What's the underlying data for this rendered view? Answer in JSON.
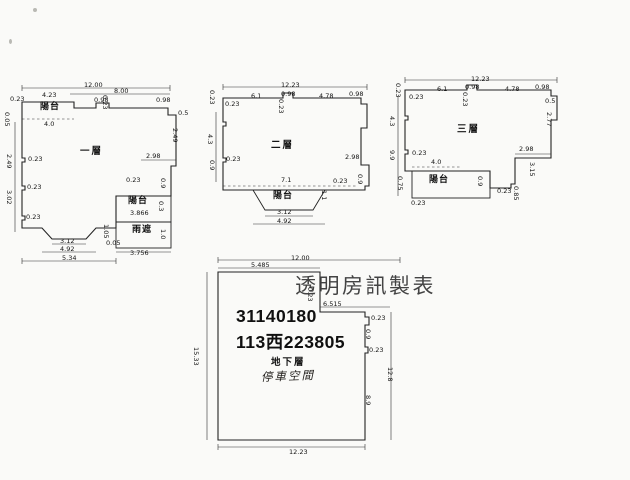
{
  "page": {
    "background": "#fafaf8",
    "line_color": "#232323"
  },
  "title_block": {
    "watermark": "透明房訊製表",
    "code_line1": "31140180",
    "code_line2": "113西223805"
  },
  "plans": [
    {
      "id": "floor1",
      "name": "一層",
      "labels": [
        {
          "t": "12.00",
          "x": 74,
          "y": 0
        },
        {
          "t": "4.23",
          "x": 32,
          "y": 10
        },
        {
          "t": "8.00",
          "x": 104,
          "y": 6
        },
        {
          "t": "0.98",
          "x": 84,
          "y": 15
        },
        {
          "t": "0.23",
          "x": 98,
          "y": 13,
          "r": 90
        },
        {
          "t": "0.98",
          "x": 146,
          "y": 15
        },
        {
          "t": "0.23",
          "x": 0,
          "y": 14
        },
        {
          "t": "陽台",
          "x": 30,
          "y": 22,
          "cls": "room"
        },
        {
          "t": "0.05",
          "x": 0,
          "y": 30,
          "r": 90
        },
        {
          "t": "4.0",
          "x": 34,
          "y": 39
        },
        {
          "t": "0.5",
          "x": 168,
          "y": 28
        },
        {
          "t": "2.49",
          "x": 168,
          "y": 46,
          "r": 90
        },
        {
          "t": "0.23",
          "x": 18,
          "y": 74
        },
        {
          "t": "2.49",
          "x": 2,
          "y": 72,
          "r": 90
        },
        {
          "t": "0.23",
          "x": 17,
          "y": 102
        },
        {
          "t": "3.02",
          "x": 2,
          "y": 108,
          "r": 90
        },
        {
          "t": "0.23",
          "x": 16,
          "y": 132
        },
        {
          "t": "2.98",
          "x": 136,
          "y": 71
        },
        {
          "t": "0.23",
          "x": 116,
          "y": 95
        },
        {
          "t": "0.9",
          "x": 156,
          "y": 96,
          "r": 90
        },
        {
          "t": "陽台",
          "x": 118,
          "y": 116,
          "cls": "room"
        },
        {
          "t": "3.866",
          "x": 120,
          "y": 128
        },
        {
          "t": "0.3",
          "x": 154,
          "y": 119,
          "r": 90
        },
        {
          "t": "雨遮",
          "x": 122,
          "y": 145,
          "cls": "room"
        },
        {
          "t": "1.05",
          "x": 99,
          "y": 142,
          "r": 90
        },
        {
          "t": "0.05",
          "x": 96,
          "y": 158
        },
        {
          "t": "1.0",
          "x": 156,
          "y": 147,
          "r": 90
        },
        {
          "t": "3.756",
          "x": 120,
          "y": 168
        },
        {
          "t": "3.12",
          "x": 50,
          "y": 156
        },
        {
          "t": "4.92",
          "x": 50,
          "y": 164
        },
        {
          "t": "5.34",
          "x": 52,
          "y": 173
        }
      ]
    },
    {
      "id": "floor2",
      "name": "二層",
      "labels": [
        {
          "t": "12.23",
          "x": 68,
          "y": 0
        },
        {
          "t": "0.23",
          "x": 2,
          "y": 8,
          "r": 90
        },
        {
          "t": "6.1",
          "x": 38,
          "y": 11
        },
        {
          "t": "0.98",
          "x": 68,
          "y": 9
        },
        {
          "t": "0.23",
          "x": 71,
          "y": 17,
          "r": 90
        },
        {
          "t": "4.78",
          "x": 106,
          "y": 11
        },
        {
          "t": "0.98",
          "x": 136,
          "y": 9
        },
        {
          "t": "0.23",
          "x": 12,
          "y": 19
        },
        {
          "t": "4.3",
          "x": 0,
          "y": 52,
          "r": 90
        },
        {
          "t": "0.23",
          "x": 13,
          "y": 74
        },
        {
          "t": "0.9",
          "x": 2,
          "y": 78,
          "r": 90
        },
        {
          "t": "2.98",
          "x": 132,
          "y": 72
        },
        {
          "t": "0.9",
          "x": 150,
          "y": 92,
          "r": 90
        },
        {
          "t": "0.23",
          "x": 120,
          "y": 96
        },
        {
          "t": "7.1",
          "x": 68,
          "y": 95
        },
        {
          "t": "1.1",
          "x": 114,
          "y": 108,
          "r": 90
        },
        {
          "t": "陽台",
          "x": 60,
          "y": 111,
          "cls": "room"
        },
        {
          "t": "3.12",
          "x": 64,
          "y": 127
        },
        {
          "t": "4.92",
          "x": 64,
          "y": 136
        }
      ]
    },
    {
      "id": "floor3",
      "name": "三層",
      "labels": [
        {
          "t": "12.23",
          "x": 76,
          "y": 0
        },
        {
          "t": "0.23",
          "x": 6,
          "y": 7,
          "r": 90
        },
        {
          "t": "6.1",
          "x": 42,
          "y": 10
        },
        {
          "t": "0.98",
          "x": 70,
          "y": 8
        },
        {
          "t": "0.23",
          "x": 73,
          "y": 16,
          "r": 90
        },
        {
          "t": "4.78",
          "x": 110,
          "y": 10
        },
        {
          "t": "0.98",
          "x": 140,
          "y": 8
        },
        {
          "t": "0.23",
          "x": 14,
          "y": 18
        },
        {
          "t": "4.3",
          "x": 0,
          "y": 40,
          "r": 90
        },
        {
          "t": "9.9",
          "x": 0,
          "y": 74,
          "r": 90
        },
        {
          "t": "0.23",
          "x": 17,
          "y": 74
        },
        {
          "t": "4.0",
          "x": 36,
          "y": 83
        },
        {
          "t": "0.75",
          "x": 8,
          "y": 100,
          "r": 90
        },
        {
          "t": "陽台",
          "x": 34,
          "y": 101,
          "cls": "room"
        },
        {
          "t": "0.9",
          "x": 88,
          "y": 100,
          "r": 90
        },
        {
          "t": "0.23",
          "x": 16,
          "y": 124
        },
        {
          "t": "0.5",
          "x": 150,
          "y": 22
        },
        {
          "t": "2.77",
          "x": 157,
          "y": 36,
          "r": 90
        },
        {
          "t": "2.98",
          "x": 124,
          "y": 70
        },
        {
          "t": "3.15",
          "x": 140,
          "y": 86,
          "r": 90
        },
        {
          "t": "0.23",
          "x": 102,
          "y": 112
        },
        {
          "t": "0.85",
          "x": 124,
          "y": 110,
          "r": 90
        }
      ]
    },
    {
      "id": "basement",
      "name": "地下層",
      "space_label": "停車空間",
      "labels": [
        {
          "t": "12.00",
          "x": 96,
          "y": 0
        },
        {
          "t": "5.485",
          "x": 56,
          "y": 7
        },
        {
          "t": "0.23",
          "x": 118,
          "y": 32,
          "r": 90
        },
        {
          "t": "6.515",
          "x": 128,
          "y": 46
        },
        {
          "t": "0.23",
          "x": 176,
          "y": 60
        },
        {
          "t": "0.9",
          "x": 176,
          "y": 74,
          "r": 90
        },
        {
          "t": "0.23",
          "x": 174,
          "y": 92
        },
        {
          "t": "15.33",
          "x": 4,
          "y": 92,
          "r": 90
        },
        {
          "t": "8.9",
          "x": 176,
          "y": 140,
          "r": 90
        },
        {
          "t": "12.8",
          "x": 198,
          "y": 112,
          "r": 90
        },
        {
          "t": "12.23",
          "x": 94,
          "y": 194
        }
      ]
    }
  ]
}
